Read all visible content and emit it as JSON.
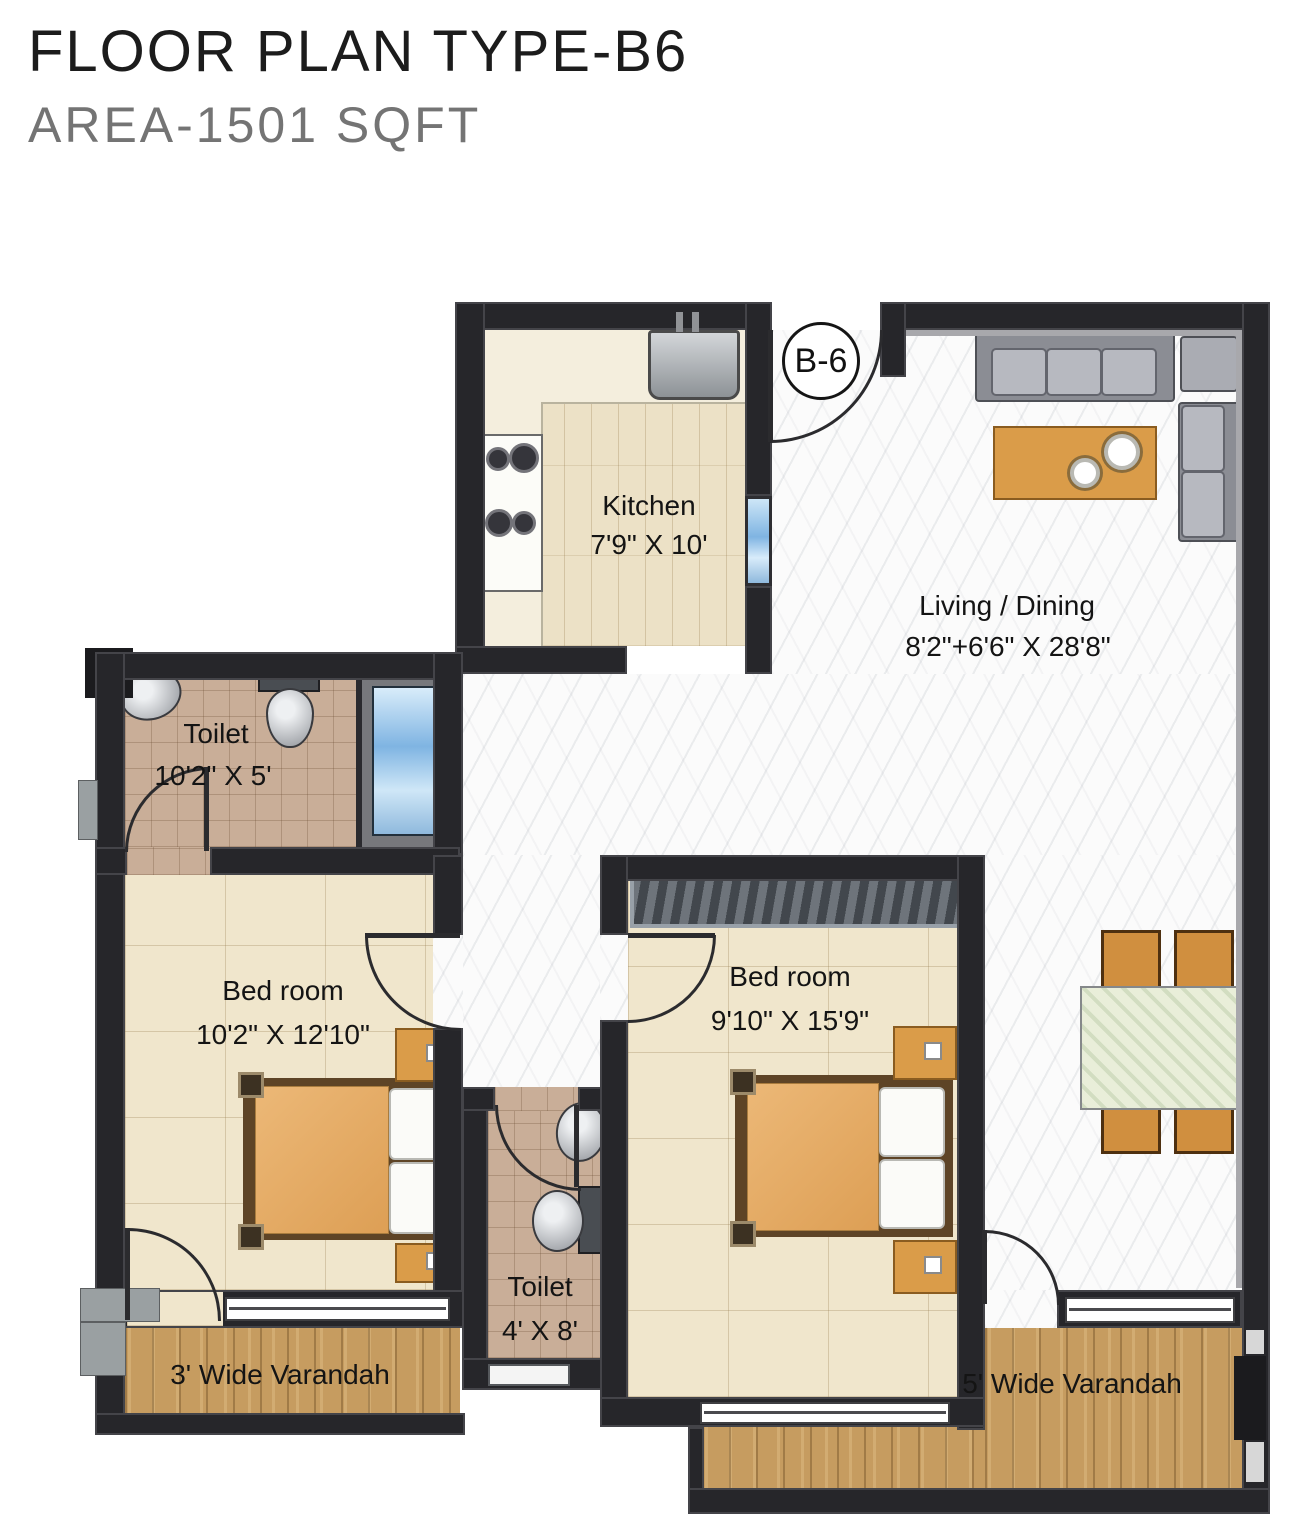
{
  "title": "FLOOR PLAN TYPE-B6",
  "subtitle": "AREA-1501 SQFT",
  "unit_badge": "B-6",
  "rooms": {
    "kitchen": {
      "name": "Kitchen",
      "size": "7'9\" X 10'"
    },
    "living_dining": {
      "name": "Living / Dining",
      "size": "8'2\"+6'6\" X 28'8\""
    },
    "toilet_main": {
      "name": "Toilet",
      "size": "10'2\" X 5'"
    },
    "bedroom_left": {
      "name": "Bed room",
      "size": "10'2\" X 12'10\""
    },
    "bedroom_right": {
      "name": "Bed room",
      "size": "9'10\" X 15'9\""
    },
    "toilet_common": {
      "name": "Toilet",
      "size": "4' X 8'"
    },
    "varandah_left": {
      "name": "3' Wide Varandah"
    },
    "varandah_right": {
      "name": "5' Wide Varandah"
    }
  },
  "colors": {
    "wall": "#26262a",
    "kitchen_floor": "#ece1c6",
    "bedroom_floor": "#f0e6cc",
    "toilet_floor": "#c9ae98",
    "hall_floor": "#fbfbfb",
    "varandah_wood": "#c69c60",
    "furniture_wood": "#da9c49",
    "bathtub_water": "#7fb4e2",
    "title_color": "#1c1c1c",
    "subtitle_color": "#747474"
  }
}
